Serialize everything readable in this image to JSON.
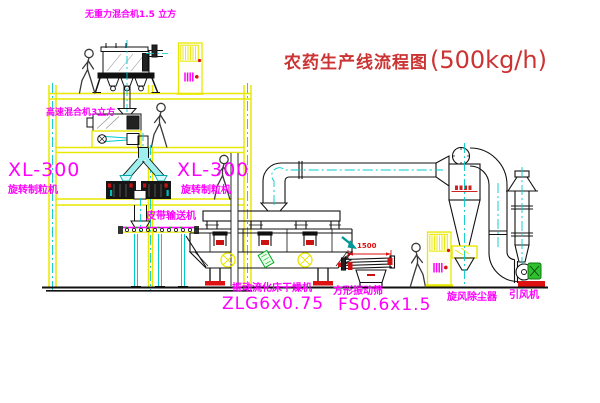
{
  "diagram": {
    "title": {
      "text": "农药生产线流程图",
      "capacity": "(500kg/h)"
    },
    "labels": {
      "gravity_mixer": "无重力混合机1.5 立方",
      "high_speed_mixer": "高速混合机3立方",
      "granulator_left": {
        "model": "XL-300",
        "name": "旋转制粒机"
      },
      "granulator_right": {
        "model": "XL-300",
        "name": "旋转制粒机"
      },
      "belt_conveyor": "皮带输送机",
      "fluid_bed_dryer": {
        "name": "振动流化床干燥机",
        "model": "ZLG6x0.75"
      },
      "vibrating_sieve": {
        "name": "方形振动筛",
        "model": "FS0.6x1.5",
        "dimension": "1500"
      },
      "cyclone": "旋风除尘器",
      "induced_draft_fan": "引风机"
    },
    "colors": {
      "label_magenta": "#ff00ff",
      "title_red": "#cc3333",
      "structure_yellow": "#e8e800",
      "centerline_cyan": "#00cccc",
      "accent_red": "#dd1111",
      "accent_green": "#2fbf2f"
    }
  }
}
